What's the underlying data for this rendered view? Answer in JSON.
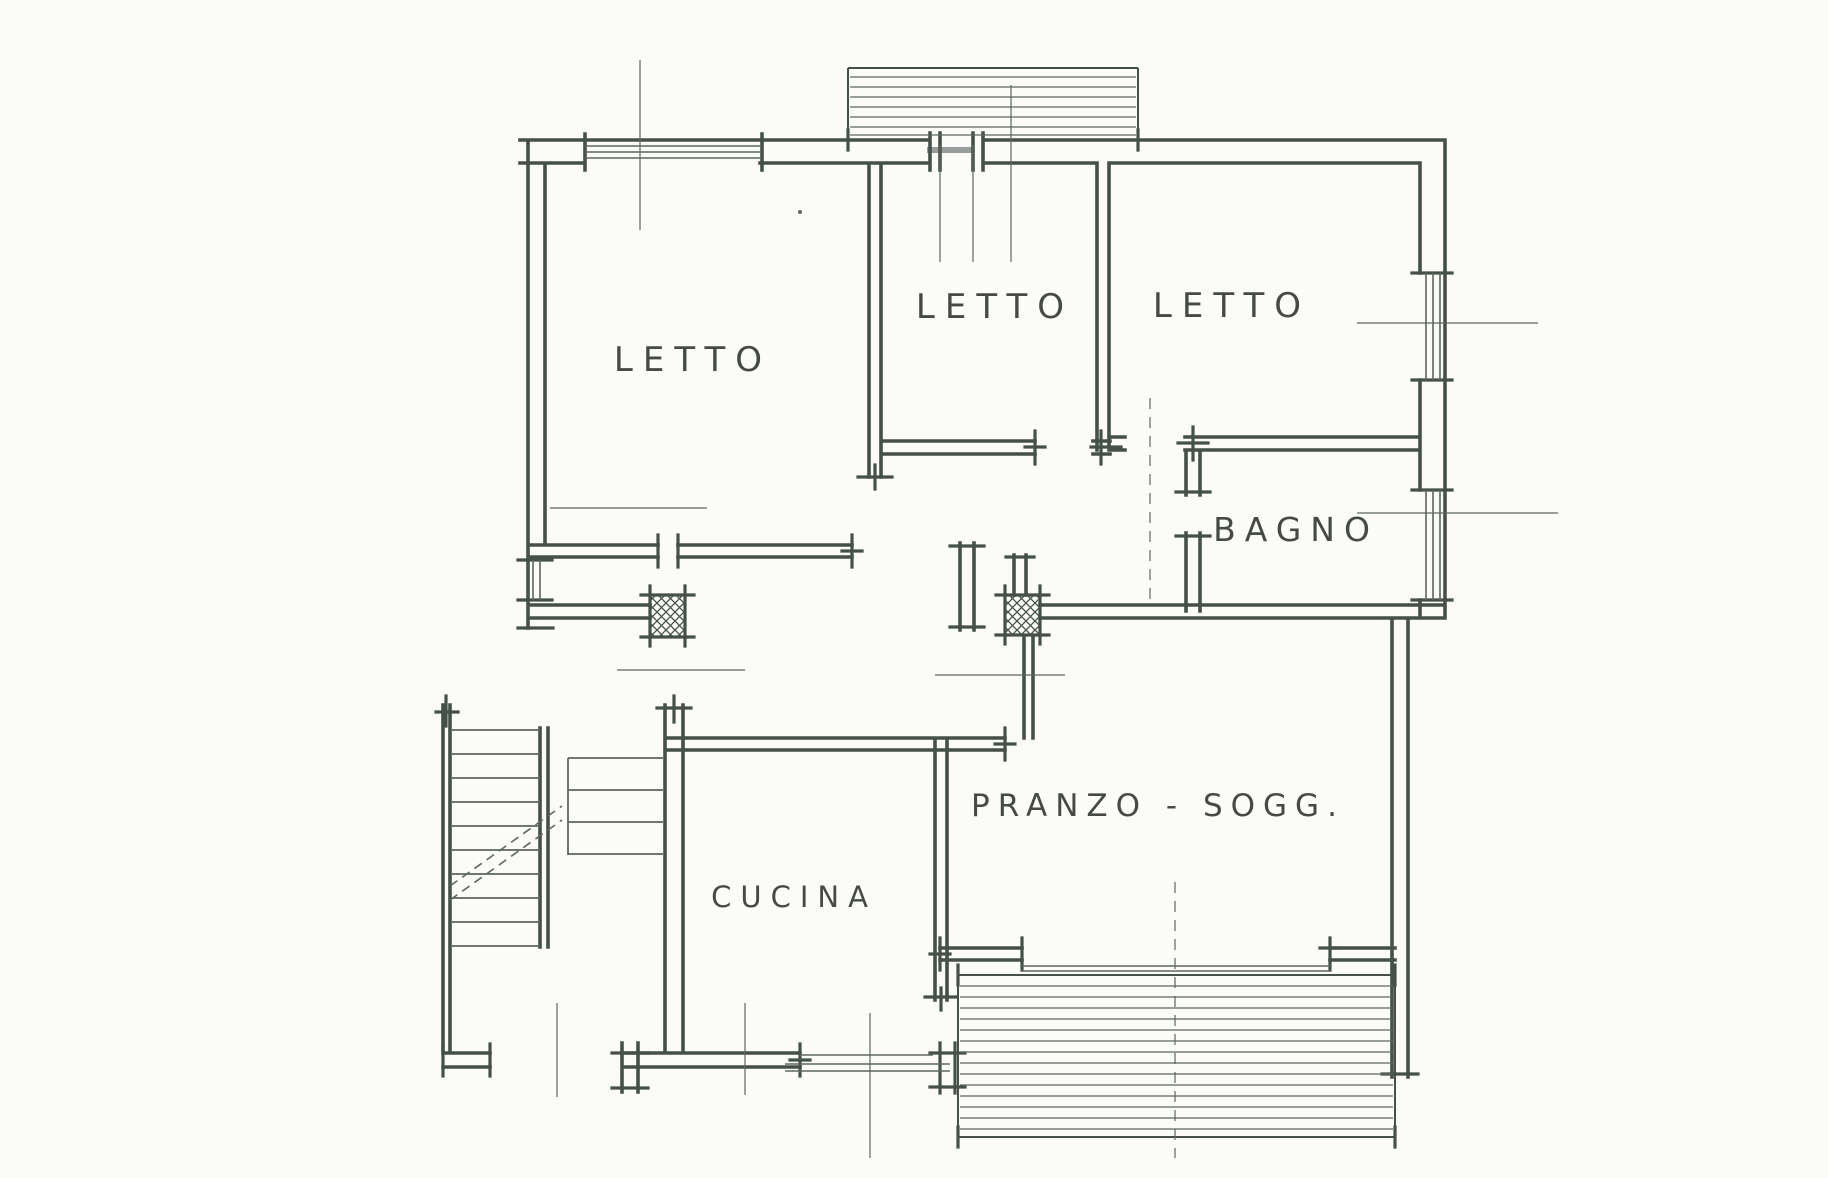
{
  "page": {
    "type": "scanned hand-drawn apartment floor plan",
    "background": "#fbfbfa"
  },
  "drawing": {
    "colors": {
      "ink": "#46504a",
      "thin": "#5e665f",
      "label": "#373b37"
    },
    "rooms": [
      {
        "id": "letto-left",
        "label": "LETTO"
      },
      {
        "id": "letto-center",
        "label": "LETTO"
      },
      {
        "id": "letto-right",
        "label": "LETTO"
      },
      {
        "id": "bagno",
        "label": "BAGNO"
      },
      {
        "id": "pranzo-soggiorno",
        "label": "PRANZO - SOGG."
      },
      {
        "id": "cucina",
        "label": "CUCINA"
      }
    ],
    "features": [
      {
        "id": "balcony-top",
        "kind": "hatched-balcony"
      },
      {
        "id": "balcony-bottom",
        "kind": "hatched-balcony"
      },
      {
        "id": "staircase",
        "kind": "stair-flights-with-treads"
      },
      {
        "id": "entry-pillars",
        "kind": "cross-hatched-masonry-pillars"
      }
    ]
  }
}
